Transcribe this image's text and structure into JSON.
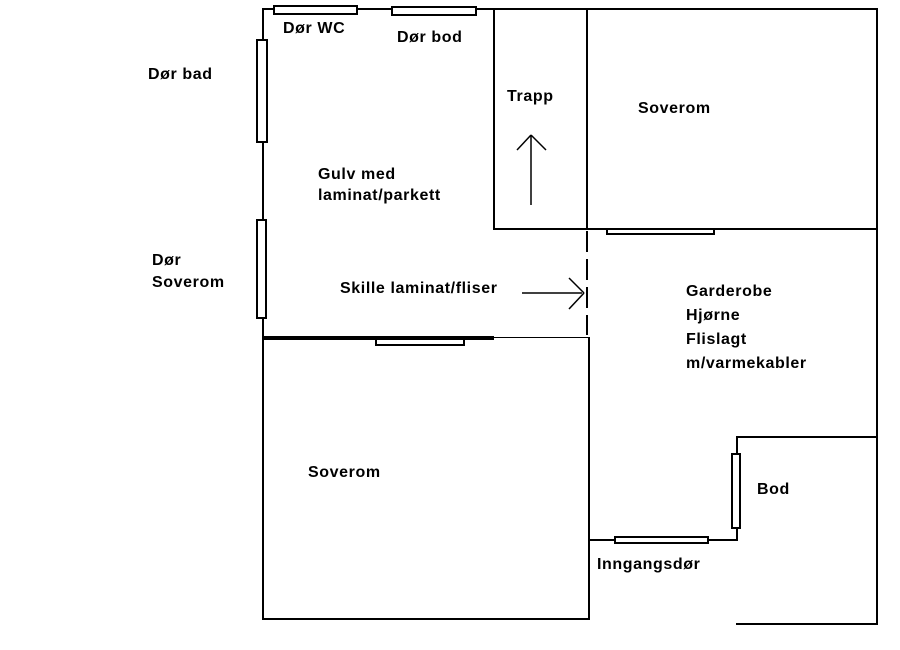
{
  "floorplan": {
    "background_color": "#ffffff",
    "line_color": "#000000",
    "labels": {
      "dor_wc": "Dør WC",
      "dor_bod": "Dør bod",
      "dor_bad": "Dør bad",
      "trapp": "Trapp",
      "soverom_upper": "Soverom",
      "gulv_line1": "Gulv med",
      "gulv_line2": "laminat/parkett",
      "dor_soverom_line1": "Dør",
      "dor_soverom_line2": "Soverom",
      "skille": "Skille laminat/fliser",
      "garderobe_line1": "Garderobe",
      "garderobe_line2": "Hjørne",
      "garderobe_line3": "Flislagt",
      "garderobe_line4": "m/varmekabler",
      "soverom_lower": "Soverom",
      "bod": "Bod",
      "inngangsdor": "Inngangsdør"
    },
    "icons": {
      "up_arrow": "stairs-up-arrow",
      "right_arrow": "divider-pointer-arrow"
    }
  }
}
